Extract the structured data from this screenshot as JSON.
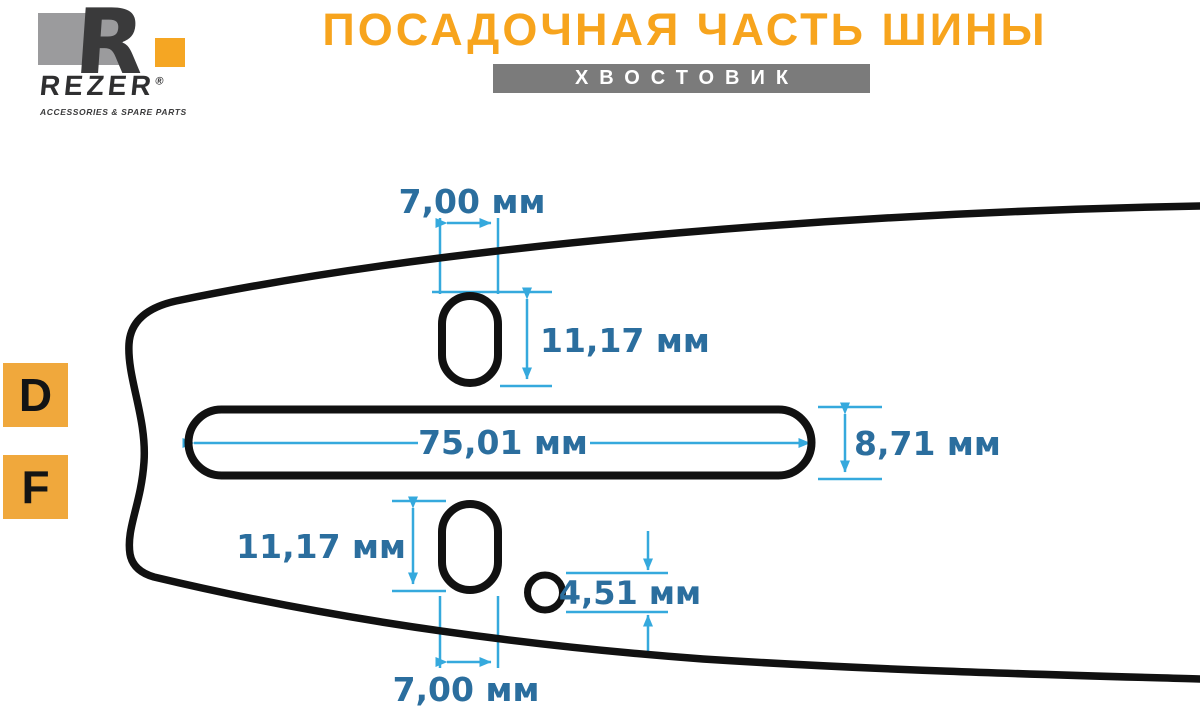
{
  "brand": {
    "monogram": "R",
    "name": "REZER",
    "reg": "®",
    "tagline": "ACCESSORIES & SPARE PARTS"
  },
  "header": {
    "title": "ПОСАДОЧНАЯ ЧАСТЬ ШИНЫ",
    "subtitle": "ХВОСТОВИК"
  },
  "side_labels": {
    "d": "D",
    "f": "F"
  },
  "dimensions": {
    "top_width": "7,00 мм",
    "upper_slot_height": "11,17 мм",
    "main_slot_length": "75,01 мм",
    "main_slot_height": "8,71 мм",
    "lower_slot_height": "11,17 мм",
    "oil_hole_diameter": "4,51 мм",
    "bottom_width": "7,00 мм"
  },
  "colors": {
    "accent_orange_title": "#F7A41D",
    "accent_orange_squares": "#F0A83C",
    "logo_orange": "#F5A623",
    "logo_gray": "#9B9B9D",
    "subtitle_bar_gray": "#7B7B7B",
    "dimension_line_blue": "#35A9DD",
    "dimension_text_blue": "#2B6E9E",
    "outline_black": "#111111"
  }
}
